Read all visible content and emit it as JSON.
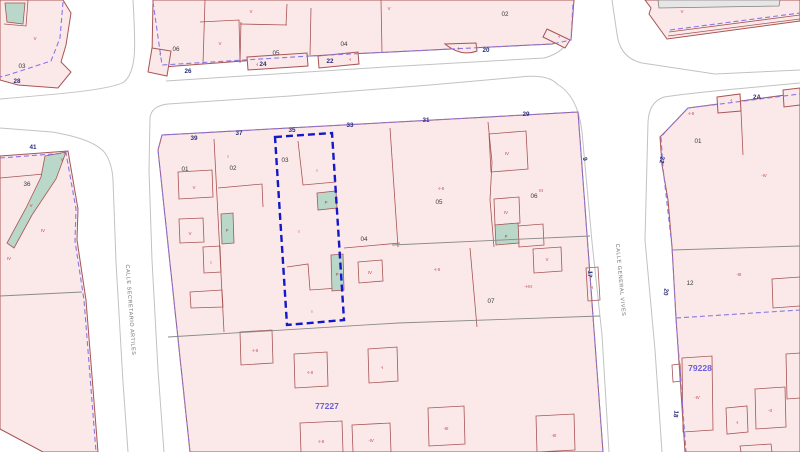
{
  "streets": {
    "left_name": "CALLE SECRETARIO ARTILES",
    "right_name": "CALLE GENERAL VIVES"
  },
  "block_numbers": {
    "main_block": "77227",
    "southeast_block": "79228"
  },
  "parcels": {
    "nw_03": "03",
    "n_06": "06",
    "n_05": "05",
    "n_04": "04",
    "n_02": "02",
    "m_01": "01",
    "m_02": "02",
    "m_03": "03",
    "m_04": "04",
    "m_05": "05",
    "m_06": "06",
    "m_07": "07",
    "w_36": "36",
    "e_01": "01",
    "e_12": "12"
  },
  "portals": {
    "p28": "28",
    "p26": "26",
    "p24": "24",
    "p22": "22",
    "p20": "20",
    "p39": "39",
    "p37": "37",
    "p35": "35",
    "p33": "33",
    "p31": "31",
    "p29": "29",
    "p41": "41",
    "p2a": "2A",
    "p9": "9",
    "p17": "17",
    "pe22": "22",
    "pe20": "20",
    "pe18": "18"
  },
  "construction_labels": {
    "c1": "V",
    "c2": "V",
    "c3": "V",
    "c4": "V",
    "c5": "-I",
    "c6": "-I",
    "c7": "-I",
    "c8": "-I",
    "c9": "-I",
    "c10": "V",
    "c11": "I",
    "c12": "V",
    "c13": "V",
    "c14": "I",
    "c15": "P",
    "c16": "I",
    "c17": "P",
    "c18": "I",
    "c19": "P",
    "c20": "I",
    "c21": "-I-II",
    "c22": "IV",
    "c23": "III",
    "c24": "IV",
    "c25": "P",
    "c26": "-I-II",
    "c27": "-I-III",
    "c28": "-I",
    "c29": "-I-II",
    "c30": "-I-II",
    "c31": "-I",
    "c32": "-I-II",
    "c33": "-IV",
    "c34": "-III",
    "c35": "-III",
    "c36": "V",
    "c37": "V",
    "c38": "IV",
    "c39": "IV",
    "c40": "-I-II",
    "c41": "-I",
    "c42": "-IV",
    "c43": "-III",
    "c44": "-IV",
    "c45": "-I",
    "c46": "-II",
    "c47": "IV",
    "c48": "V"
  },
  "colors": {
    "selected_parcel": "#1318c8",
    "block_fill": "#fbe9e9",
    "parcel_line": "#a85454",
    "patio_fill": "#b9d8c9",
    "alignment_line": "#8878e8",
    "portal_text": "#2b2f77",
    "block_number_text": "#6a5fd8",
    "construction_text": "#c23b3b"
  }
}
